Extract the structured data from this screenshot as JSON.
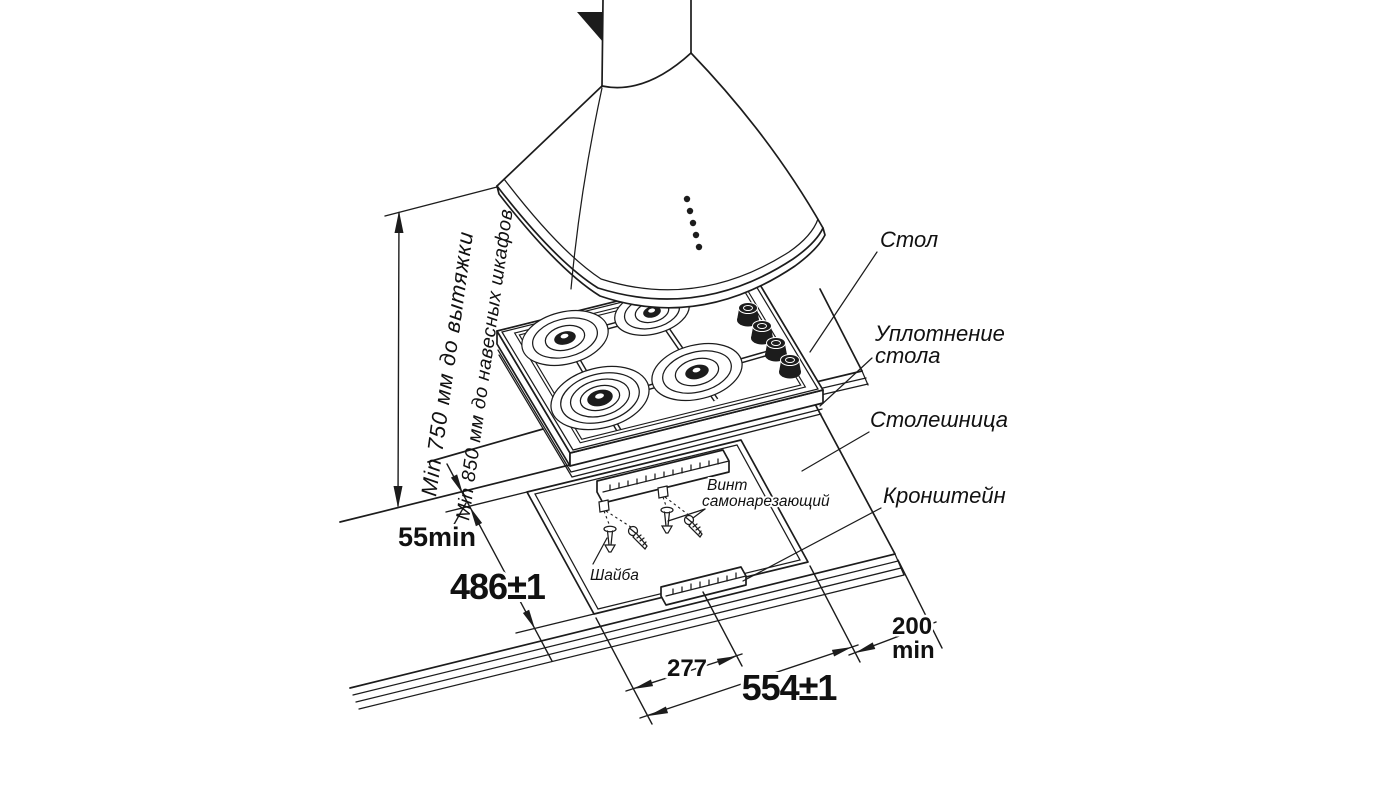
{
  "diagram": {
    "labels": {
      "stol": "Стол",
      "uplotnenie_line1": "Уплотнение",
      "uplotnenie_line2": "стола",
      "stoleshnitsa": "Столешница",
      "kronshtein": "Кронштейн",
      "vint_line1": "Винт",
      "vint_line2": "самонарезающий",
      "shaiba": "Шайба"
    },
    "dimensions": {
      "hood_clearance": "Min 750 мм до вытяжки",
      "cabinet_clearance": "Min 850 мм до навесных шкафов",
      "rear_gap": "55min",
      "cutout_depth": "486±1",
      "cutout_half_width": "277",
      "cutout_width": "554±1",
      "side_clearance_value": "200",
      "side_clearance_unit": "min"
    },
    "colors": {
      "line": "#1c1c1c",
      "background": "#ffffff"
    }
  }
}
